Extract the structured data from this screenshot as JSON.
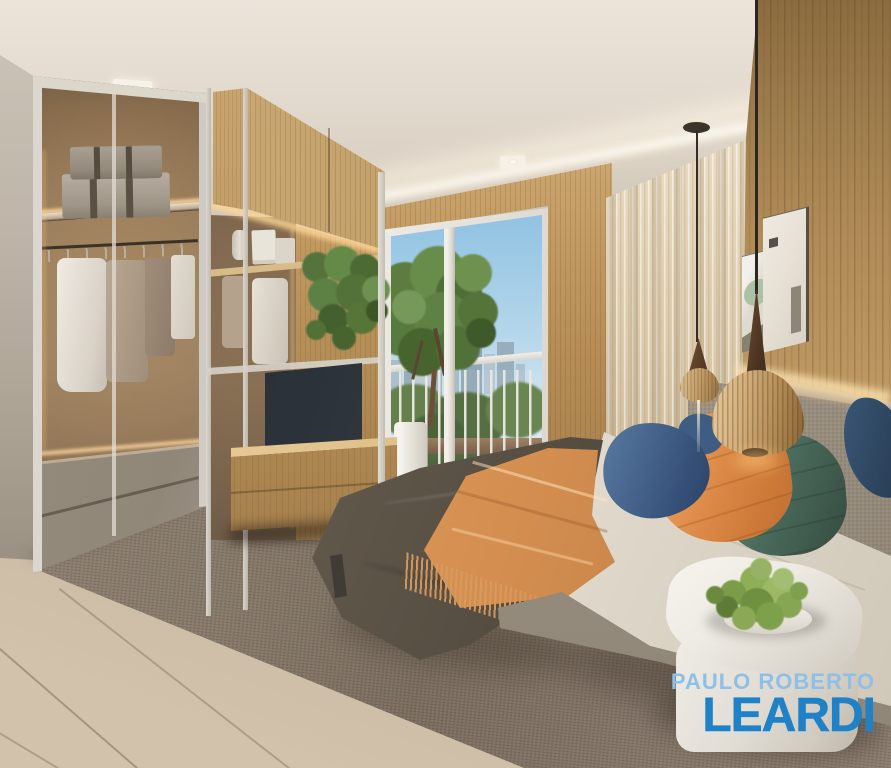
{
  "image": {
    "kind": "interior-render-photograph",
    "room": "bedroom",
    "visible_objects": [
      "wardrobe with glass doors and warm lit interior",
      "two suitcases on wardrobe shelf",
      "hanging clothes on rail",
      "wood and glass partition shelving unit",
      "television on wood console",
      "hanging green plant on shelf",
      "decor objects on shelf",
      "balcony window with white frame and railing",
      "tree in white planter on balcony",
      "city skyline above park trees",
      "smooth wood feature wall",
      "sheer curtains with cove lighting",
      "wood slat headboard wall with LED strip",
      "two framed abstract artworks",
      "two wooden teardrop pendant lamps",
      "bed with dark duvet and white sheets",
      "orange fringed throw blanket",
      "navy orange and green pillows",
      "gray upholstered headboard",
      "white rounded nightstand",
      "green plant in low bowl on nightstand",
      "woven area rug",
      "stone tile floor",
      "recessed ceiling spotlights"
    ]
  },
  "watermark": {
    "line1": "PAULO ROBERTO",
    "line2": "LEARDI",
    "line1_color": "#8ec0e6",
    "line2_color": "#1f82c8"
  },
  "palette": {
    "ceiling": "#e2dacf",
    "wood": "#c19c66",
    "curtain": "#e8dcc6",
    "duvet": "#5c5348",
    "throw": "#dd9c60",
    "pillow_blue": "#3f5f88",
    "pillow_orange": "#dd8a48",
    "pillow_green": "#4c6f62",
    "headboard": "#aca090",
    "rug": "#8a7d6f",
    "floor": "#bfae9a",
    "sky": "#a9d0e8",
    "park": "#4c6839"
  }
}
